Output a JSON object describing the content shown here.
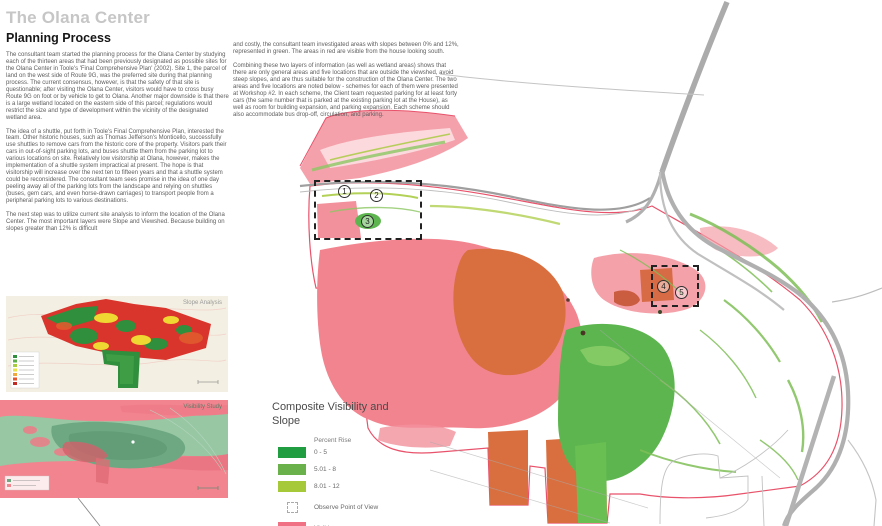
{
  "document": {
    "title": "The Olana Center",
    "section": "Planning Process",
    "col1": {
      "para1": "The consultant team started the planning process for the Olana Center by studying each of the thirteen areas that had been previously designated as possible sites for the Olana Center in Toole's 'Final Comprehensive Plan' (2002). Site 1, the parcel of land on the west side of Route 9G, was the preferred site during that planning process. The current consensus, however, is that the safety of that site is questionable; after visiting the Olana Center, visitors would have to cross busy Route 9G on foot or by vehicle to get to Olana. Another major downside is that there is a large wetland located on the eastern side of this parcel; regulations would restrict the size and type of development within the vicinity of the designated wetland area.",
      "para2": "The idea of a shuttle, put forth in Toole's Final Comprehensive Plan, interested the team. Other historic houses, such as Thomas Jefferson's Monticello, successfully use shuttles to remove cars from the historic core of the property. Visitors park their cars in out-of-sight parking lots, and buses shuttle them from the parking lot to various locations on site. Relatively low visitorship at Olana, however, makes the implementation of a shuttle system impractical at present. The hope is that visitorship will increase over the next ten to fifteen years and that a shuttle system could be reconsidered. The consultant team sees promise in the idea of one day peeling away all of the parking lots from the landscape and relying on shuttles (buses, gem cars, and even horse-drawn carriages) to transport people from a peripheral parking lots to various destinations.",
      "para3": "The next step was to utilize current site analysis to inform the location of the Olana Center. The most important layers were Slope and Viewshed. Because building on slopes greater than 12% is difficult"
    },
    "col2": {
      "para1": "and costly, the consultant team investigated areas with slopes between 0% and 12%, represented in green. The areas in red are visible from the house looking south.",
      "para2": "Combining these two layers of information (as well as wetland areas) shows that there are only general areas and five locations that are outside the viewshed, avoid steep slopes, and are thus suitable for the construction of the Olana Center. The two areas and five locations are noted below - schemes for each of them were presented at Workshop #2. In each scheme, the Client team requested parking for at least forty cars (the same number that is parked at the existing parking lot at the House), as well as room for building expansion, and parking expansion. Each scheme should also accommodate bus drop-off, circulation, and parking."
    }
  },
  "minimaps": {
    "slope_label": "Slope Analysis",
    "visibility_label": "Visibility Study"
  },
  "legend": {
    "title": "Composite Visibility and Slope",
    "header": "Percent Rise",
    "items": [
      {
        "label": "0 - 5",
        "color": "#1f9d40"
      },
      {
        "label": "5.01 - 8",
        "color": "#6ab14c"
      },
      {
        "label": "8.01 - 12",
        "color": "#a6c939"
      },
      {
        "label": "Observe Point of View",
        "color": "dashed"
      },
      {
        "label": "Visible",
        "color": "#ef7183"
      }
    ]
  },
  "map": {
    "markers": [
      {
        "label": "1"
      },
      {
        "label": "2"
      },
      {
        "label": "3"
      },
      {
        "label": "4"
      },
      {
        "label": "5"
      }
    ],
    "palette": {
      "visible_pink": "#f2848f",
      "highly_visible_orange": "#d96f3f",
      "slope_green_dark": "#1f9d40",
      "slope_green_mid": "#6ab14c",
      "slope_green_light": "#a6c939",
      "road_gray": "#aeaeae",
      "boundary_red": "#e8526a"
    }
  }
}
